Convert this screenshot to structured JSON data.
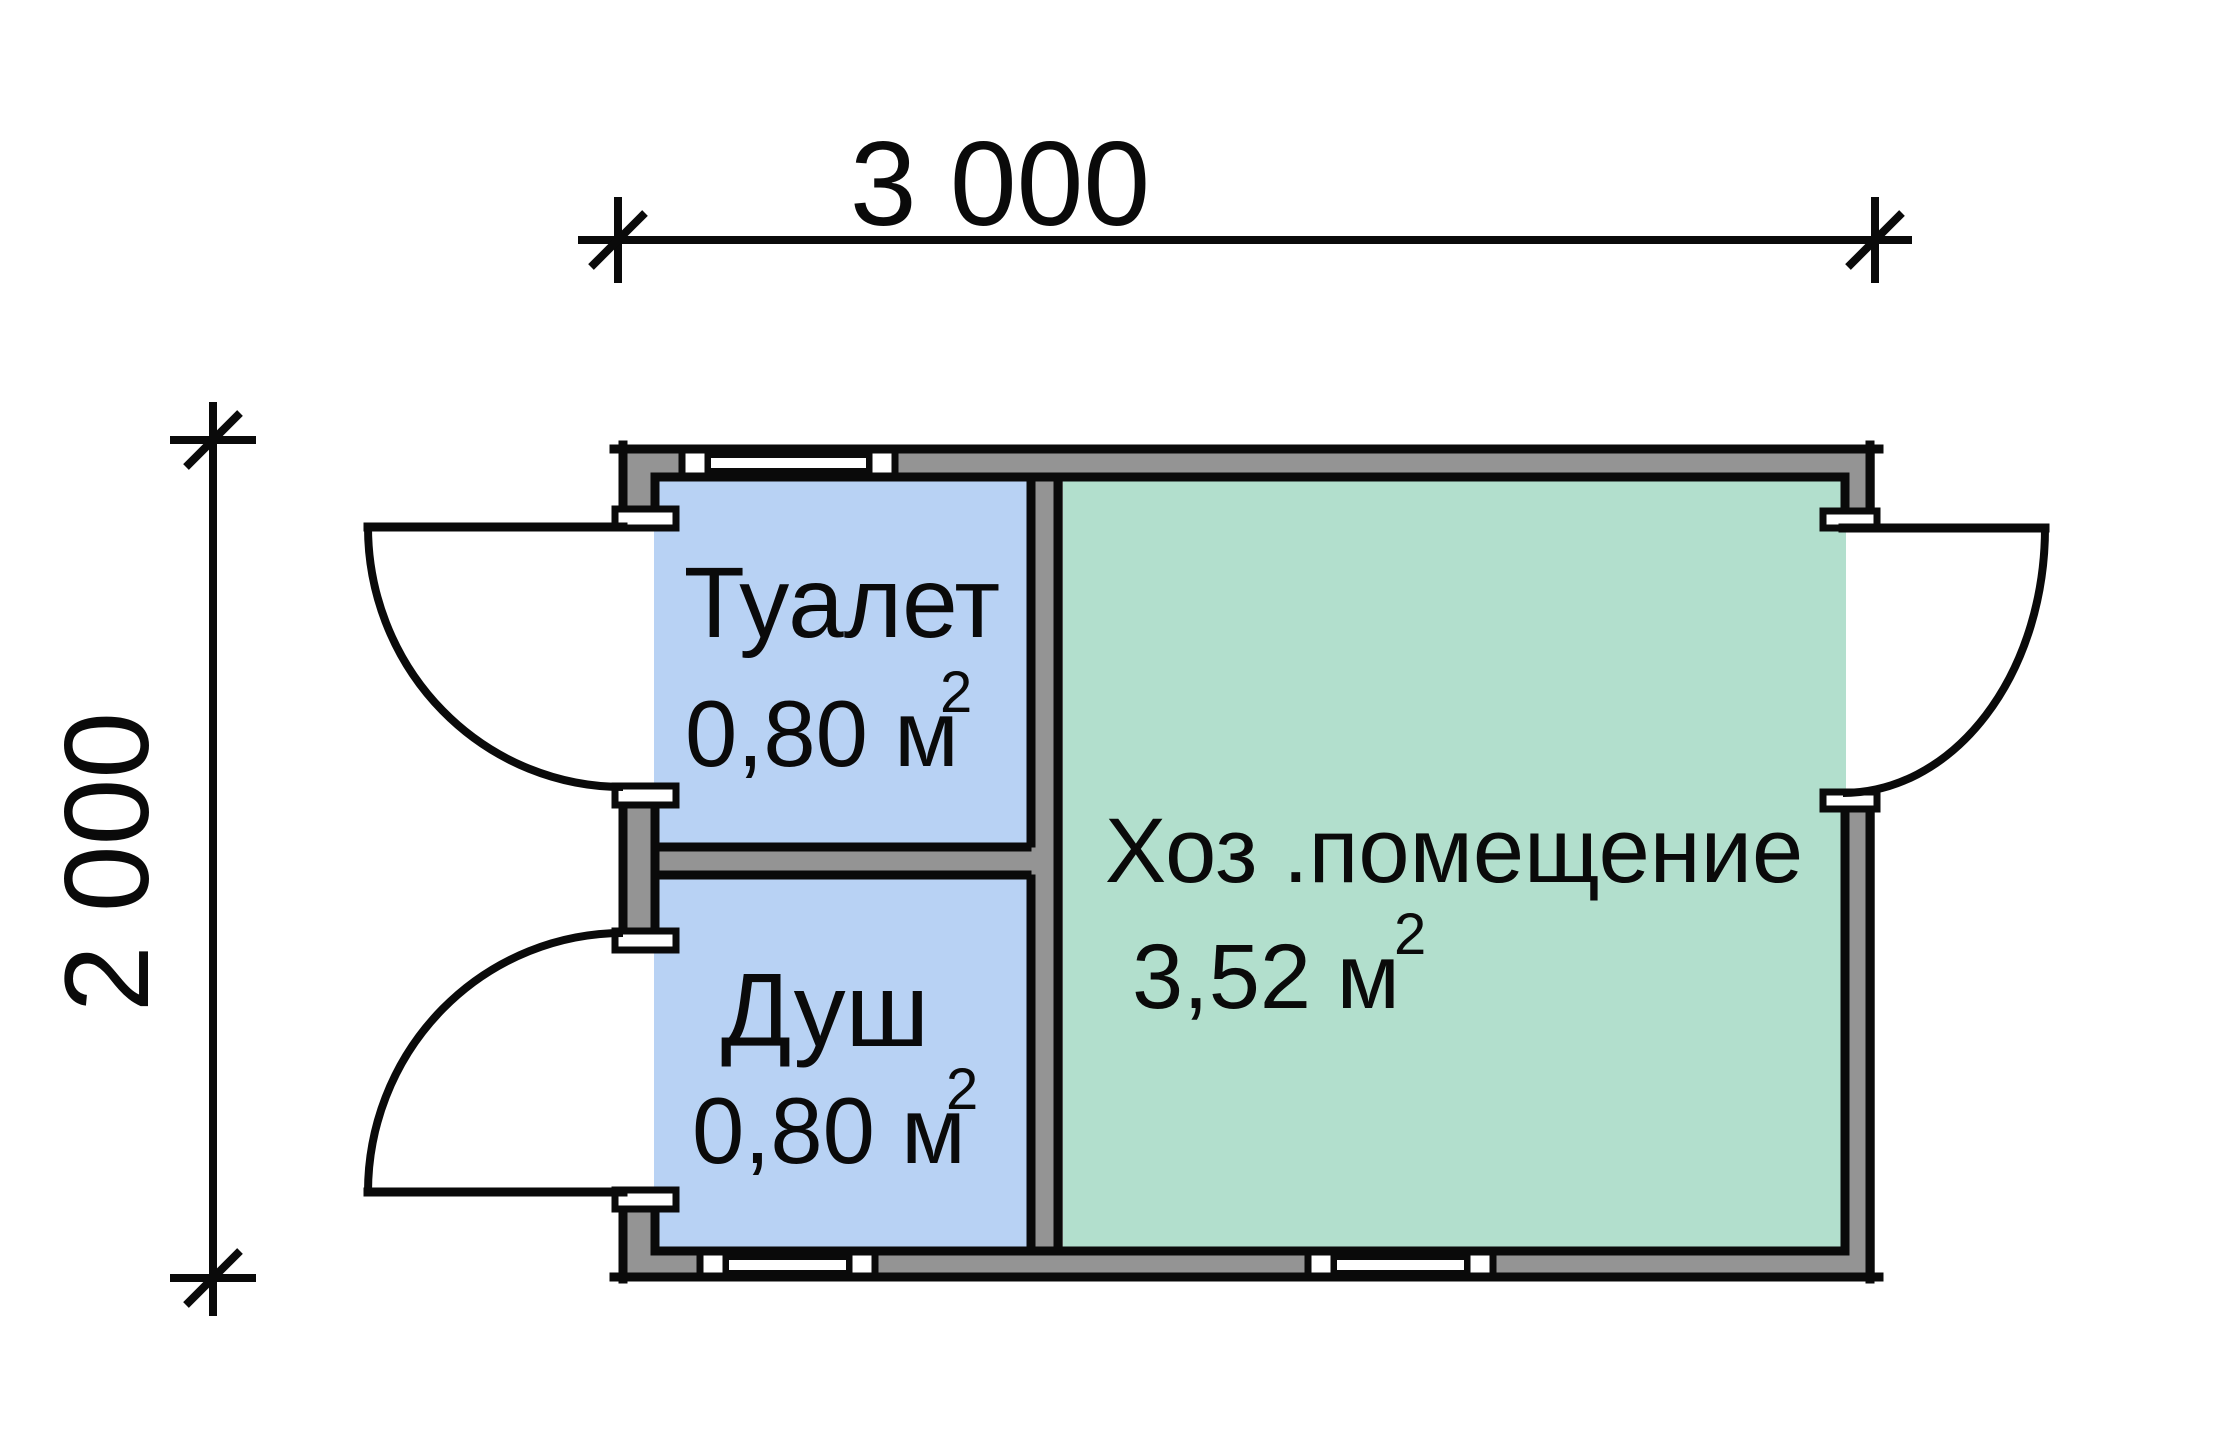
{
  "drawing": {
    "type": "floor-plan",
    "dimensions": {
      "width_label": "3 000",
      "height_label": "2 000"
    },
    "rooms": {
      "toilet": {
        "name": "Туалет",
        "area_text": "0,80 м",
        "area_sup": "2"
      },
      "shower": {
        "name": "Душ",
        "area_text": "0,80 м",
        "area_sup": "2"
      },
      "utility": {
        "name": "Хоз .помещение",
        "area_text": "3,52 м",
        "area_sup": "2"
      }
    },
    "colors": {
      "room_blue": "#b8d2f4",
      "room_green": "#b2dfcd",
      "wall_gray": "#949494",
      "line_black": "#0a0a0a",
      "opening_white": "#ffffff"
    }
  }
}
